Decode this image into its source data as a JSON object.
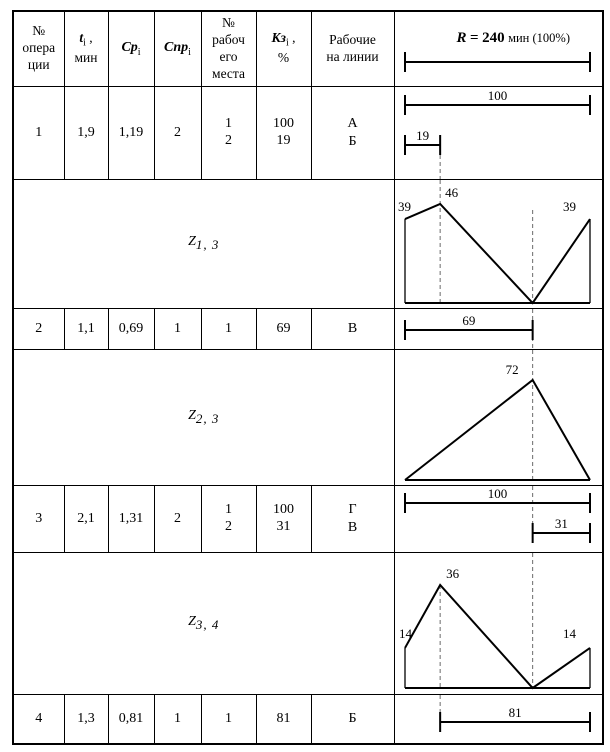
{
  "header": {
    "col_operation": [
      "№",
      "опера",
      "ции"
    ],
    "col_t": {
      "sym": "t",
      "sub": "i",
      "comma": " ,",
      "line2": "мин"
    },
    "col_cp": {
      "sym": "Ср",
      "sub": "i"
    },
    "col_cnp": {
      "sym": "Спр",
      "sub": "i"
    },
    "col_place": [
      "№",
      "рабоч",
      "его",
      "места"
    ],
    "col_kz": {
      "sym": "Кз",
      "sub": "i",
      "comma": " ,",
      "line2": "%"
    },
    "col_workers": [
      "Рабочие",
      "на линии"
    ],
    "scale": {
      "r": "R",
      "eq": "=",
      "value": "240",
      "units": "мин (100%)"
    }
  },
  "rows": [
    {
      "num": "1",
      "t": "1,9",
      "cp": "1,19",
      "cnp": "2",
      "place1": "1",
      "place2": "2",
      "kz1": "100",
      "kz2": "19",
      "worker1": "А",
      "worker2": "Б"
    },
    {
      "num": "2",
      "t": "1,1",
      "cp": "0,69",
      "cnp": "1",
      "place1": "1",
      "kz1": "69",
      "worker1": "В"
    },
    {
      "num": "3",
      "t": "2,1",
      "cp": "1,31",
      "cnp": "2",
      "place1": "1",
      "place2": "2",
      "kz1": "100",
      "kz2": "31",
      "worker1": "Г",
      "worker2": "В"
    },
    {
      "num": "4",
      "t": "1,3",
      "cp": "0,81",
      "cnp": "1",
      "place1": "1",
      "kz1": "81",
      "worker1": "Б"
    }
  ],
  "z_rows": [
    {
      "sym": "Z",
      "sub": "1, 3"
    },
    {
      "sym": "Z",
      "sub": "2, 3"
    },
    {
      "sym": "Z",
      "sub": "3, 4"
    }
  ],
  "chart_data": [
    {
      "id": "scale",
      "type": "dimension",
      "title": "R = 240 мин (100%)",
      "axis_range_pct": [
        0,
        100
      ],
      "bars": [
        {
          "from": 0,
          "to": 100,
          "y": 50,
          "label": ""
        }
      ],
      "dashes": []
    },
    {
      "id": "op1",
      "type": "dimension",
      "note": "occupancy bars of operation 1 in % of R=240",
      "bars": [
        {
          "from": 0,
          "to": 100,
          "y": 18,
          "label": "100"
        },
        {
          "from": 0,
          "to": 19,
          "y": 58,
          "label": "19"
        }
      ],
      "dashes": [
        {
          "x": 19,
          "y0": 68,
          "y1": 999
        }
      ]
    },
    {
      "id": "z13",
      "type": "area",
      "name": "Z 1,3",
      "xlabel_pct": [
        0,
        100
      ],
      "profile": [
        [
          0,
          39
        ],
        [
          19,
          46
        ],
        [
          69,
          0
        ],
        [
          100,
          39
        ]
      ],
      "walls": true,
      "base_y": -5,
      "peak_top": 24,
      "labels": [
        {
          "text": "39",
          "x": 0,
          "v": 39,
          "dx": -7,
          "dy": -8
        },
        {
          "text": "46",
          "x": 19,
          "v": 46,
          "dx": 5,
          "dy": -7
        },
        {
          "text": "39",
          "x": 100,
          "v": 39,
          "dx": -27,
          "dy": -8
        }
      ],
      "dashes": [
        {
          "x": 19,
          "y0": 0,
          "y1": -5
        },
        {
          "x": 69,
          "y0": 30,
          "y1": -5
        }
      ]
    },
    {
      "id": "op2",
      "type": "dimension",
      "bars": [
        {
          "from": 0,
          "to": 69,
          "y": 21,
          "label": "69"
        }
      ],
      "dashes": [
        {
          "x": 69,
          "y0": 0,
          "y1": 999
        }
      ]
    },
    {
      "id": "z23",
      "type": "area",
      "name": "Z 2,3",
      "profile": [
        [
          0,
          0
        ],
        [
          69,
          72
        ],
        [
          100,
          0
        ]
      ],
      "walls": false,
      "base_y": -5,
      "peak_top": 30,
      "labels": [
        {
          "text": "72",
          "x": 69,
          "v": 72,
          "dx": -27,
          "dy": -6
        }
      ],
      "dashes": [
        {
          "x": 69,
          "y0": 0,
          "y1": -5
        }
      ]
    },
    {
      "id": "op3",
      "type": "dimension",
      "bars": [
        {
          "from": 0,
          "to": 100,
          "y": 17,
          "label": "100"
        },
        {
          "from": 69,
          "to": 100,
          "y": 47,
          "label": "31"
        }
      ],
      "dashes": [
        {
          "x": 69,
          "y0": 0,
          "y1": 57
        }
      ]
    },
    {
      "id": "z34",
      "type": "area",
      "name": "Z 3,4",
      "profile": [
        [
          0,
          14
        ],
        [
          19,
          36
        ],
        [
          69,
          0
        ],
        [
          100,
          14
        ]
      ],
      "walls": true,
      "base_y": -6,
      "peak_top": 32,
      "labels": [
        {
          "text": "14",
          "x": 0,
          "v": 14,
          "dx": -6,
          "dy": -10
        },
        {
          "text": "36",
          "x": 19,
          "v": 36,
          "dx": 6,
          "dy": -7
        },
        {
          "text": "14",
          "x": 100,
          "v": 14,
          "dx": -27,
          "dy": -10
        }
      ],
      "dashes": [
        {
          "x": 19,
          "y0": 32,
          "y1": -6
        },
        {
          "x": 69,
          "y0": 0,
          "y1": -6
        }
      ]
    },
    {
      "id": "op4",
      "type": "dimension",
      "bars": [
        {
          "from": 19,
          "to": 100,
          "y": 27,
          "label": "81"
        }
      ],
      "dashes": [
        {
          "x": 19,
          "y0": 0,
          "y1": 27
        }
      ]
    }
  ]
}
